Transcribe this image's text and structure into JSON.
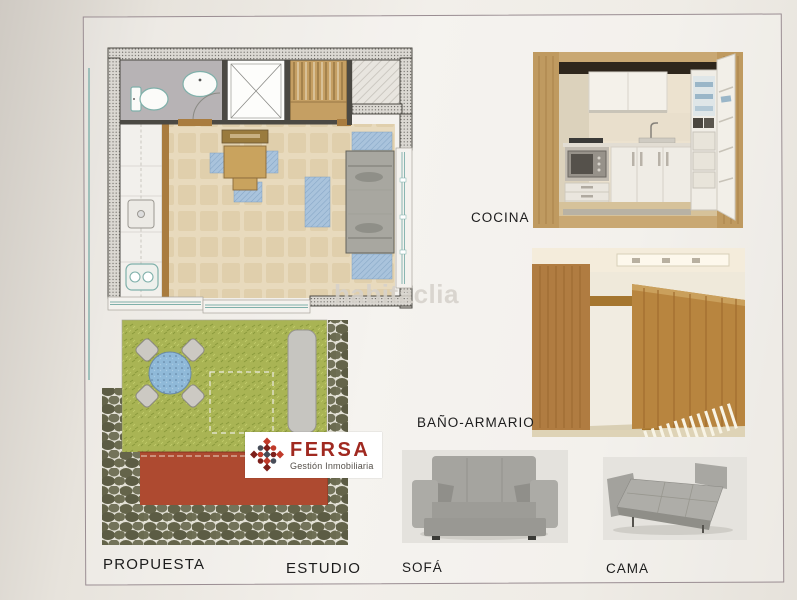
{
  "photo_labels": {
    "cocina": "COCINA",
    "bano_armario": "BAÑO-ARMARIO",
    "sofa": "SOFÁ",
    "cama": "CAMA"
  },
  "plan_labels": {
    "propuesta": "PROPUESTA",
    "estudio": "ESTUDIO"
  },
  "logo": {
    "brand": "FERSA",
    "tagline": "Gestión Inmobiliaria"
  },
  "watermark": {
    "text": "habitaclia"
  },
  "theme": {
    "frame-line": "#9a8d92",
    "label-color": "#1c1c1c",
    "watermark-color": "#d6d2cb",
    "logo-red": "#a02920",
    "logo-bright-red": "#c03a2a",
    "logo-dark-red": "#7d1f1a",
    "logo-slate": "#474c58",
    "logo-slate-text": "#55504a",
    "plan-wall": "#4b4943",
    "plan-bath-floor": "#b7b3b5",
    "plan-fixture-teal": "#7fb0aa",
    "plan-wood": "#c59f63",
    "plan-threshold": "#a97c3f",
    "plan-floor-beige": "#e8dabd",
    "plan-blue": "#a9c3dc",
    "plan-sofa-gray": "#a8a7a0",
    "garden-grass": "#a9b454",
    "garden-terrace-red": "#ae4a30",
    "garden-stone": "#64644a",
    "garden-pool-blue": "#8fb9d8"
  }
}
